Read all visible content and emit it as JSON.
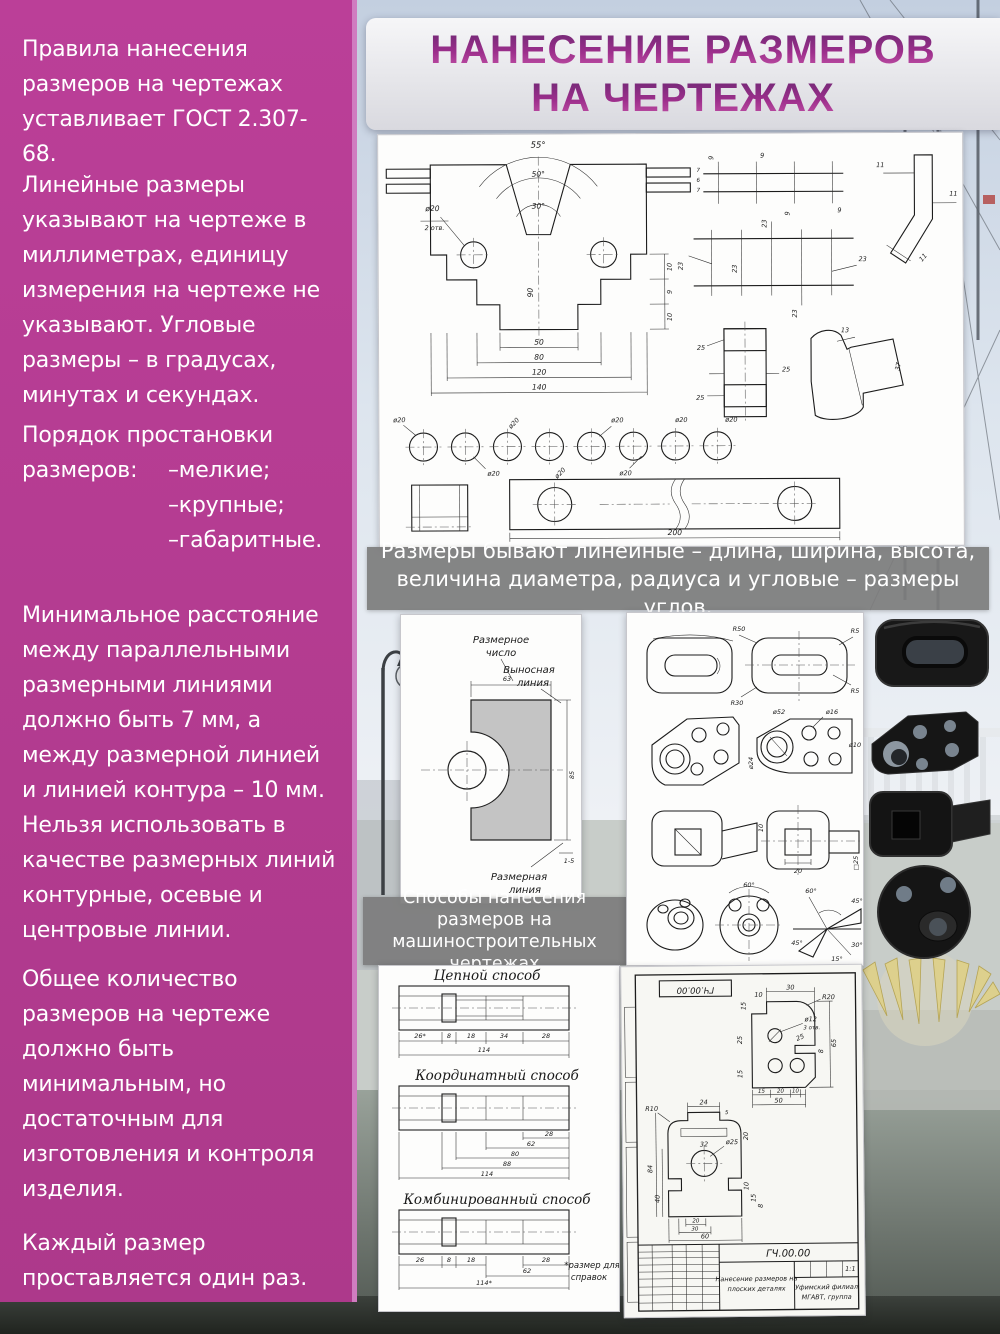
{
  "title": {
    "line1": "НАНЕСЕНИЕ РАЗМЕРОВ",
    "line2": "НА ЧЕРТЕЖАХ"
  },
  "sidebar": {
    "p1": "Правила нанесения размеров на чертежах уставливает ГОСТ 2.307-68.",
    "p2": "Линейные размеры указывают на чертеже в миллиметрах, единицу измерения на чертеже не указывают. Угловые размеры – в градусах, минутах и секундах.",
    "p3_line1": "Порядок простановки",
    "p3_line2": "размеров:",
    "p3_items": [
      "–мелкие;",
      "–крупные;",
      "–габаритные."
    ],
    "p4": "Минимальное расстояние между параллельными размерными линиями должно быть 7 мм, а между размерной линией и линией контура – 10 мм. Нельзя использовать в качестве размерных линий контурные, осевые и центровые линии.",
    "p5": "Общее количество размеров на чертеже должно быть минимальным, но достаточным для изготовления и контроля изделия.",
    "p6": "Каждый размер проставляется один раз."
  },
  "captions": {
    "c1": "Размеры бывают линейные – длина, ширина, высота, величина диаметра, радиуса и угловые – размеры углов.",
    "c2": "Способы нанесения размеров на машиностроительных чертежах"
  },
  "top_panel": {
    "angles": [
      "55°",
      "50°",
      "30°"
    ],
    "hole": "ø20",
    "hole_note": "2 отв.",
    "vdim": "90",
    "hdims": [
      "50",
      "80",
      "120",
      "140"
    ],
    "side_dims": [
      "10",
      "9",
      "10"
    ],
    "plate_dims": [
      "7",
      "6",
      "7"
    ],
    "nine": "9",
    "twentythree": "23",
    "eleven": "11",
    "twentyfive": "25",
    "thirteen": "13",
    "thirtyseven": "37",
    "circle_dia": "ø20",
    "plate_len": "200"
  },
  "terms_panel": {
    "dim_number_l1": "Размерное",
    "dim_number_l2": "число",
    "ext_line_l1": "Выносная",
    "ext_line_l2": "линия",
    "dim_line_l1": "Размерная",
    "dim_line_l2": "линия",
    "width_dim": "63",
    "height_dim": "85",
    "gap_dim": "1-5"
  },
  "examples_panel": {
    "r1": [
      "R50",
      "R5",
      "R30",
      "R5"
    ],
    "r2": [
      "ø52",
      "ø16",
      "ø10",
      "ø24"
    ],
    "r3": [
      "20",
      "□25",
      "10"
    ],
    "r4": [
      "60°",
      "45°",
      "30°",
      "15°"
    ]
  },
  "methods_panel": {
    "chain_title": "Цепной способ",
    "chain_dims": [
      "26*",
      "8",
      "18",
      "34",
      "28"
    ],
    "chain_total": "114",
    "coord_title": "Координатный способ",
    "coord_dims": [
      "28",
      "62",
      "80",
      "88",
      "114"
    ],
    "comb_title": "Комбинированный способ",
    "comb_dims": [
      "26",
      "8",
      "18",
      "28",
      "62"
    ],
    "comb_total": "114*",
    "note_l1": "*размер для",
    "note_l2": "справок"
  },
  "sheet_panel": {
    "stamp": "ГЧ.00.00",
    "code": "ГЧ.00.00",
    "doc_title_l1": "Нанесение размеров на",
    "doc_title_l2": "плоских деталях",
    "scale": "1:1",
    "org_l1": "Уфимский филиал",
    "org_l2": "МГАВТ, группа",
    "p1": {
      "d30": "30",
      "d15": "15",
      "d10": "10",
      "r20": "R20",
      "d25s": "25",
      "d8": "8",
      "d65": "65",
      "hole": "ø12",
      "holes": "3 отв.",
      "d25l": "25",
      "d15l": "15",
      "b15": "15",
      "b20": "20",
      "b10": "10",
      "b50": "50"
    },
    "p2": {
      "r10": "R10",
      "d24": "24",
      "d5": "5",
      "d32": "32",
      "d20": "20",
      "d84": "84",
      "d40": "40",
      "hole": "ø25",
      "b20": "20",
      "b30": "30",
      "b60": "60",
      "s10": "10",
      "s15": "15",
      "s8": "8"
    }
  }
}
